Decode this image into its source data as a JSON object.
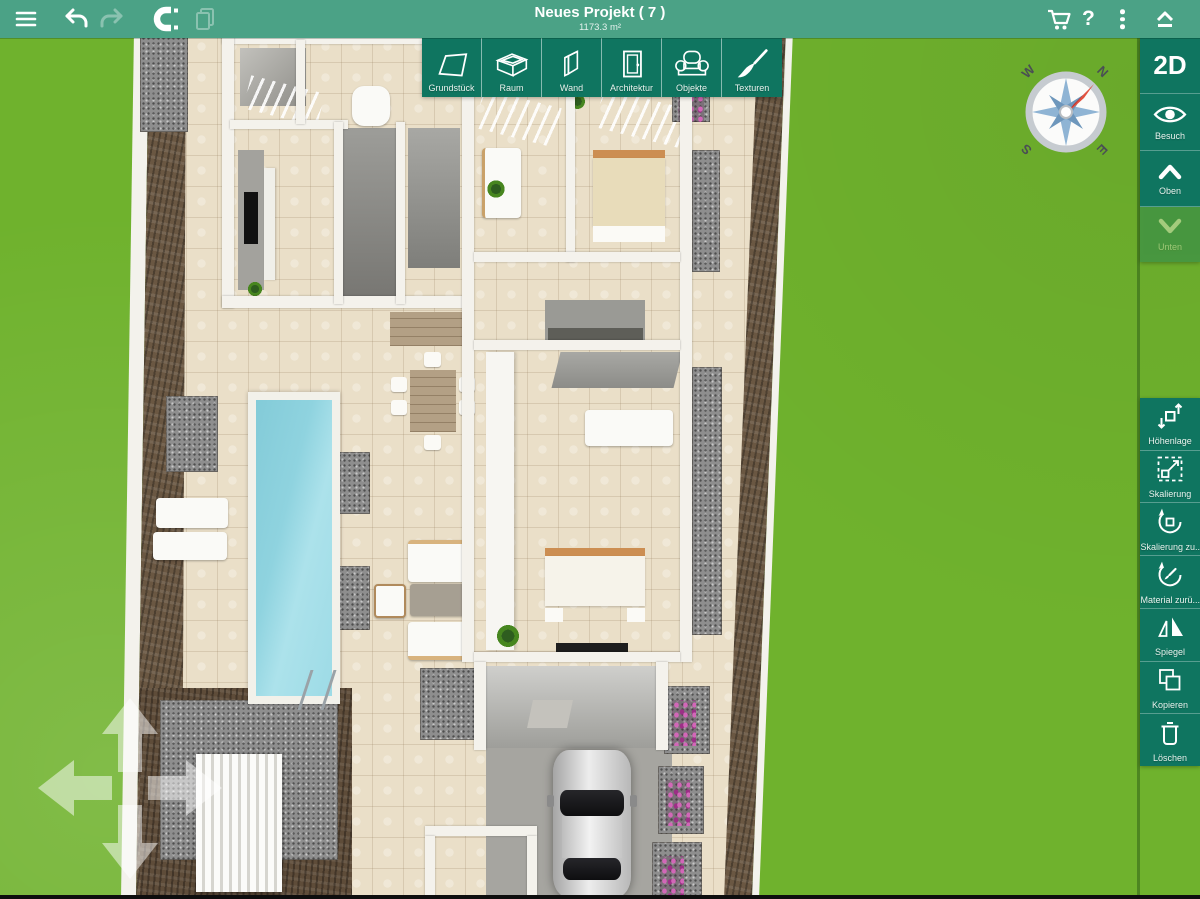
{
  "header": {
    "title": "Neues Projekt ( 7 )",
    "subtitle": "1173.3 m²",
    "help_label": "?",
    "left_icons": [
      "menu-icon",
      "undo-icon",
      "redo-icon",
      "magnet-snap-icon",
      "copy-paste-icon"
    ],
    "right_icons": [
      "cart-icon",
      "help-icon",
      "more-icon",
      "collapse-toolbar-icon"
    ]
  },
  "palette": {
    "items": [
      {
        "id": "grundstueck",
        "label": "Grundstück",
        "icon": "plot-icon"
      },
      {
        "id": "raum",
        "label": "Raum",
        "icon": "room-box-icon"
      },
      {
        "id": "wand",
        "label": "Wand",
        "icon": "wall-icon"
      },
      {
        "id": "architektur",
        "label": "Architektur",
        "icon": "door-icon"
      },
      {
        "id": "objekte",
        "label": "Objekte",
        "icon": "armchair-icon"
      },
      {
        "id": "texturen",
        "label": "Texturen",
        "icon": "paintbrush-icon"
      }
    ]
  },
  "view_controls": {
    "mode": "2D",
    "items": [
      {
        "id": "besuch",
        "label": "Besuch",
        "icon": "eye-icon"
      },
      {
        "id": "oben",
        "label": "Oben",
        "icon": "chevron-up-icon"
      },
      {
        "id": "unten",
        "label": "Unten",
        "icon": "chevron-down-icon",
        "disabled": true
      }
    ]
  },
  "edit_tools": {
    "items": [
      {
        "id": "hoehenlage",
        "label": "Höhenlage",
        "icon": "elevation-icon"
      },
      {
        "id": "skalierung",
        "label": "Skalierung",
        "icon": "scale-icon"
      },
      {
        "id": "skalierung-zuruecksetzen",
        "label": "Skalierung zu...",
        "icon": "reset-scale-icon"
      },
      {
        "id": "material-zuruecksetzen",
        "label": "Material zurü...",
        "icon": "reset-material-icon"
      },
      {
        "id": "spiegel",
        "label": "Spiegel",
        "icon": "mirror-icon"
      },
      {
        "id": "kopieren",
        "label": "Kopieren",
        "icon": "copy-icon"
      },
      {
        "id": "loeschen",
        "label": "Löschen",
        "icon": "trash-icon"
      }
    ]
  },
  "compass": {
    "north": "N",
    "east": "E",
    "south": "S",
    "west": "W"
  },
  "colors": {
    "topbar_green": "#4BA286",
    "button_green": "#0F7560",
    "grass_green": "#6FB22D",
    "needle_red": "#C9261C",
    "pool_blue": "#9BDAE5"
  }
}
